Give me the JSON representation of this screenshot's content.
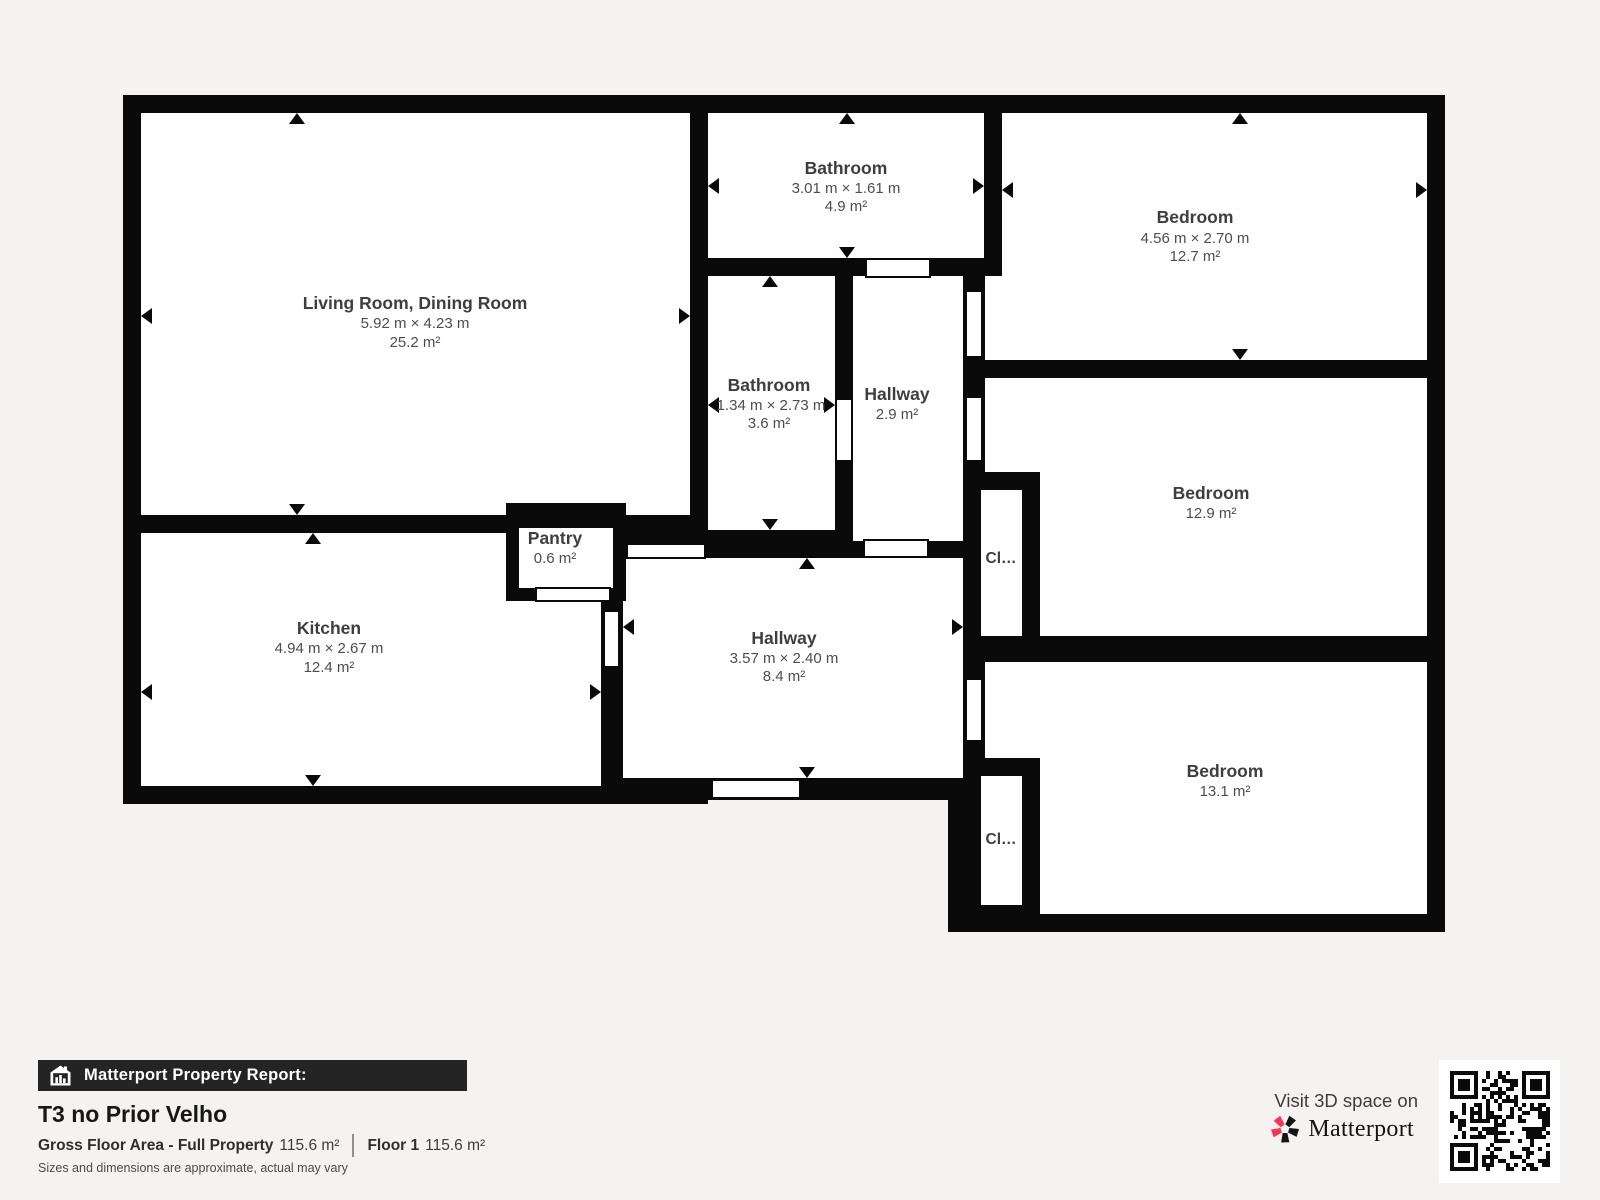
{
  "theme": {
    "background": "#f4f3f1",
    "wall_color": "#0a0a0a",
    "room_fill": "#ffffff",
    "accent_pink": "#ff3158",
    "bar_color": "#242424"
  },
  "rooms": {
    "living": {
      "name": "Living Room, Dining Room",
      "dims": "5.92 m × 4.23 m",
      "area": "25.2 m²"
    },
    "bath_top": {
      "name": "Bathroom",
      "dims": "3.01 m × 1.61 m",
      "area": "4.9 m²"
    },
    "bed_tr": {
      "name": "Bedroom",
      "dims": "4.56 m × 2.70 m",
      "area": "12.7 m²"
    },
    "bath_mid": {
      "name": "Bathroom",
      "dims": "1.34 m × 2.73 m",
      "area": "3.6 m²"
    },
    "hall_small": {
      "name": "Hallway",
      "area": "2.9 m²"
    },
    "bed_mr": {
      "name": "Bedroom",
      "area": "12.9 m²"
    },
    "kitchen": {
      "name": "Kitchen",
      "dims": "4.94 m × 2.67 m",
      "area": "12.4 m²"
    },
    "pantry": {
      "name": "Pantry",
      "area": "0.6 m²"
    },
    "hall_main": {
      "name": "Hallway",
      "dims": "3.57 m × 2.40 m",
      "area": "8.4 m²"
    },
    "bed_br": {
      "name": "Bedroom",
      "area": "13.1 m²"
    },
    "closet1": {
      "name": "Cl…"
    },
    "closet2": {
      "name": "Cl…"
    }
  },
  "footer": {
    "report_label": "Matterport Property Report:",
    "property_title": "T3 no Prior Velho",
    "gfa_label": "Gross Floor Area - Full Property",
    "gfa_value": "115.6 m²",
    "floor_label": "Floor 1",
    "floor_value": "115.6 m²",
    "disclaimer": "Sizes and dimensions are approximate, actual may vary"
  },
  "promo": {
    "visit_text": "Visit 3D space on",
    "brand": "Matterport"
  }
}
